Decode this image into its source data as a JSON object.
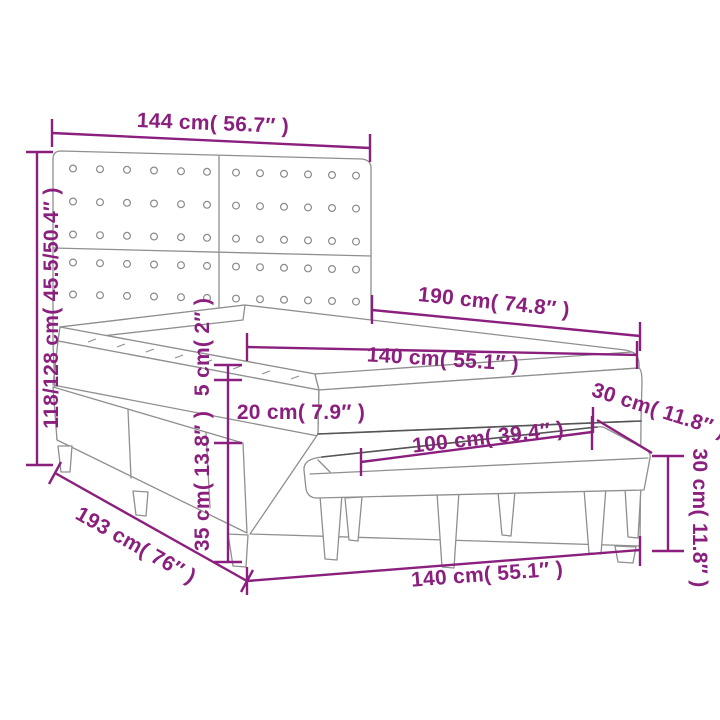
{
  "diagram": {
    "name": "box-spring-bed-with-bench-dimension-diagram",
    "accent_color": "#8A1F7E",
    "outline_color": "#8f8f8f",
    "labels": {
      "headboard_width": "144 cm( 56.7″ )",
      "height_range": "118/128 cm( 45.5/50.4″ )",
      "bed_length": "190 cm( 74.8″ )",
      "mattress_width": "140 cm( 55.1″ )",
      "topper_height": "5 cm( 2″ )",
      "mattress_height": "20 cm( 7.9″ )",
      "base_height": "35 cm( 13.8″ )",
      "bench_length": "100 cm( 39.4″ )",
      "bench_depth": "30 cm( 11.8″ )",
      "bench_height": "30 cm( 11.8″ )",
      "bed_depth": "193 cm( 76″ )",
      "bed_width": "140 cm( 55.1″ )"
    }
  }
}
